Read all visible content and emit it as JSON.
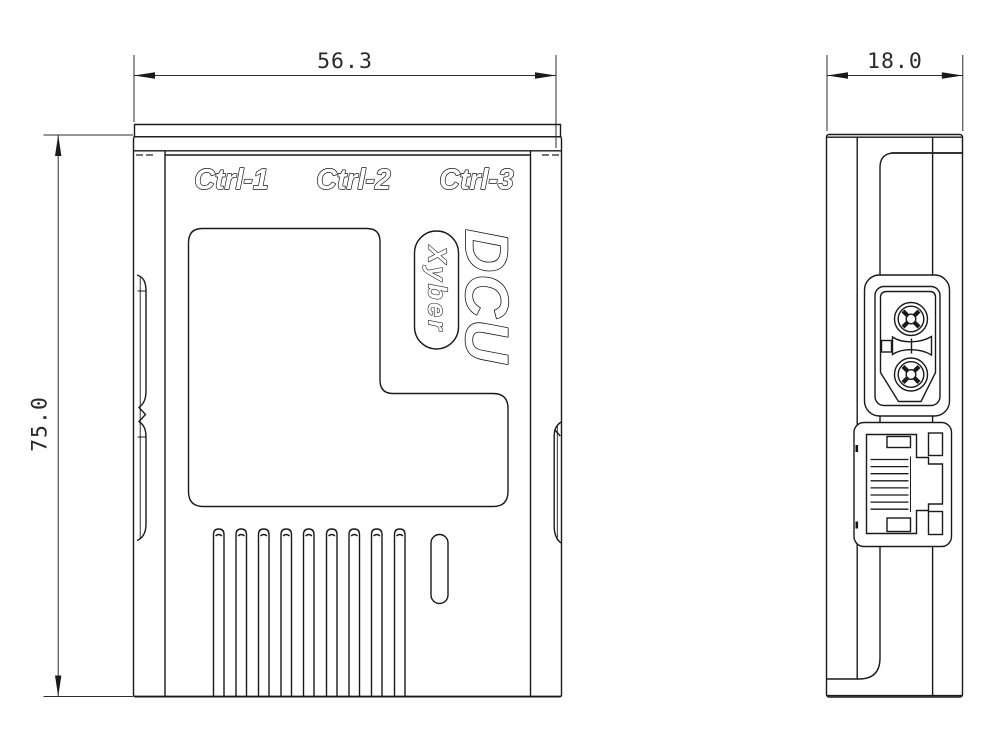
{
  "labels": {
    "port1": "Ctrl-1",
    "port2": "Ctrl-2",
    "port3": "Ctrl-3",
    "product": "DCU",
    "brand": "Xyber"
  },
  "dimensions": {
    "width": "56.3",
    "depth": "18.0",
    "height": "75.0"
  },
  "colors": {
    "line": "#1a1a1a",
    "background": "#ffffff"
  }
}
